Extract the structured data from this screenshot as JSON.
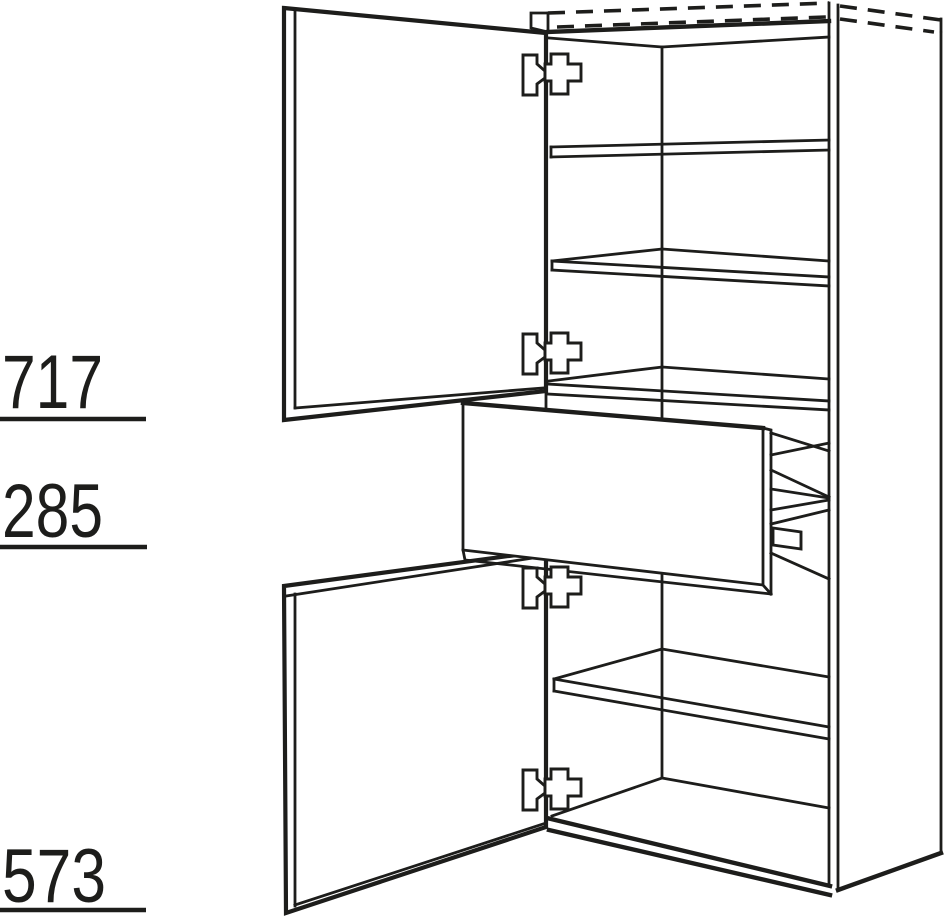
{
  "page": {
    "background": "#ffffff",
    "line_color": "#1d1d1b"
  },
  "diagram": {
    "dimensions": [
      {
        "id": "upper-section-height",
        "value": "717"
      },
      {
        "id": "drawer-section-height",
        "value": "285"
      },
      {
        "id": "lower-section-height",
        "value": "573"
      }
    ]
  },
  "icons": {
    "hinge": "concealed-hinge-icon"
  }
}
